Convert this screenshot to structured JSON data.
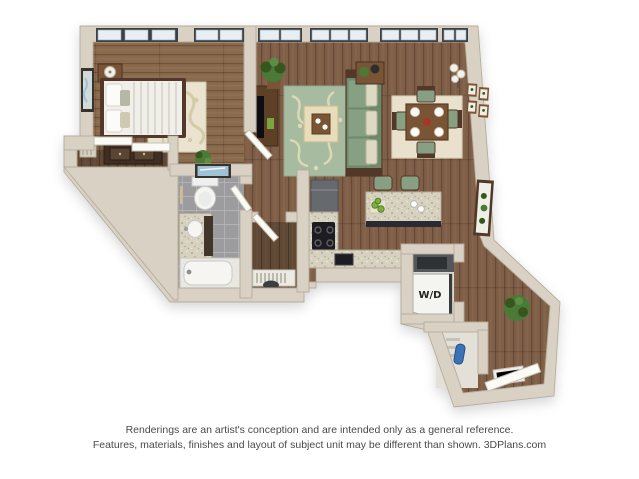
{
  "floorplan": {
    "labels": {
      "washer_dryer": "W/D"
    },
    "rooms": [
      "bedroom",
      "bedroom-closet",
      "bathroom",
      "walk-in-closet",
      "hallway",
      "living-room",
      "dining-area",
      "kitchen",
      "laundry-closet",
      "entry",
      "coat-closet"
    ]
  },
  "disclaimer": {
    "line1": "Renderings are an artist's conception and are intended only as a general reference.",
    "line2": "Features, materials, finishes and layout of subject unit may be different than shown. 3DPlans.com"
  },
  "colors": {
    "background": "#ffffff",
    "wall-face": "#d9d1c3",
    "wall-edge": "#b5ac9c",
    "floor-main": "#7f5f47",
    "floor-bedroom": "#8a6a4e",
    "floor-dark": "#5f4936",
    "tile": "#9c9c9e",
    "tile-grout": "#b9b9bb",
    "rug-living": "#a7bba0",
    "rug-scroll": "#ded8ba",
    "rug-dining": "#e9e1cd",
    "rug-bedroom": "#eae3cf",
    "rug-bedroom-pattern": "#d6cba8",
    "sofa": "#87a083",
    "sofa-dark": "#6e8a6a",
    "cushion-cream": "#ddd9c2",
    "wood-dark": "#53392a",
    "wood-mid": "#7a5436",
    "granite": "#d7d1bf",
    "cabinet-gray": "#66696d",
    "appliance-black": "#1d1e21",
    "white-fixture": "#f6f5f2",
    "window-glass": "#e8eff4",
    "window-frame": "#3b4046",
    "plant-green": "#4c7a38",
    "plant-dark": "#35571f",
    "pear-green": "#7fae3e",
    "accent-red": "#a93528",
    "art-blue": "#9fc2d6",
    "door-white": "#fafaf7",
    "ottoman": "#e7ddbb",
    "wd-box": "#f4f4f1",
    "laundry-shelf": "#53565a",
    "vacuum-blue": "#3a72b5",
    "label-text": "#222222",
    "disclaimer-text": "#4a4a4a"
  }
}
